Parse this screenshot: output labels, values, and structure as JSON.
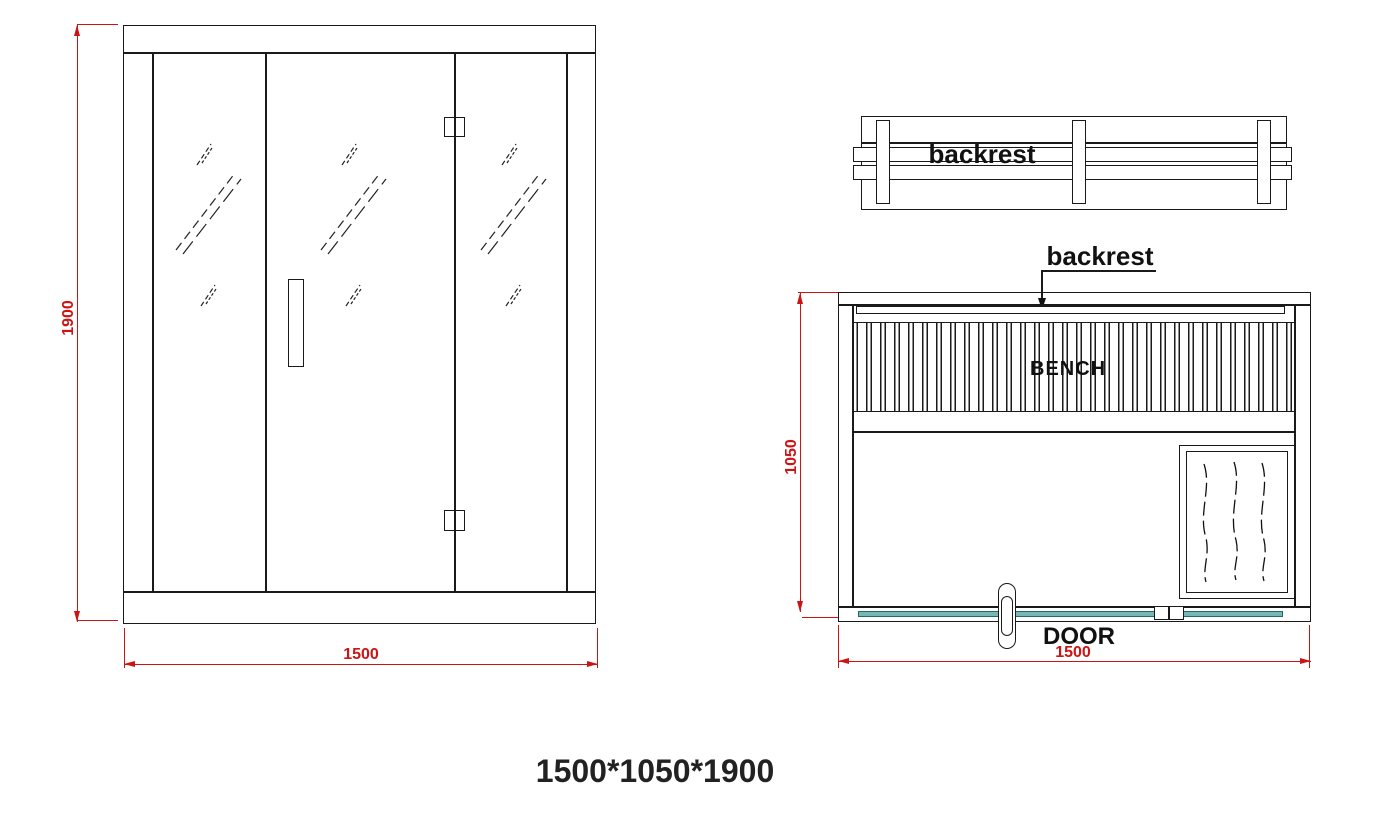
{
  "colors": {
    "line": "#1a1a1a",
    "dimension_red": "#cc1414",
    "glass_door_fill": "#79b6b6",
    "glass_door_border": "#1f6b6b"
  },
  "front_view": {
    "height_dim": "1900",
    "width_dim": "1500"
  },
  "backrest_detail": {
    "label": "backrest"
  },
  "plan_view": {
    "backrest_callout": "backrest",
    "bench_label": "BENCH",
    "door_label": "DOOR",
    "depth_dim": "1050",
    "width_dim": "1500"
  },
  "footer": {
    "size_label": "1500*1050*1900"
  }
}
